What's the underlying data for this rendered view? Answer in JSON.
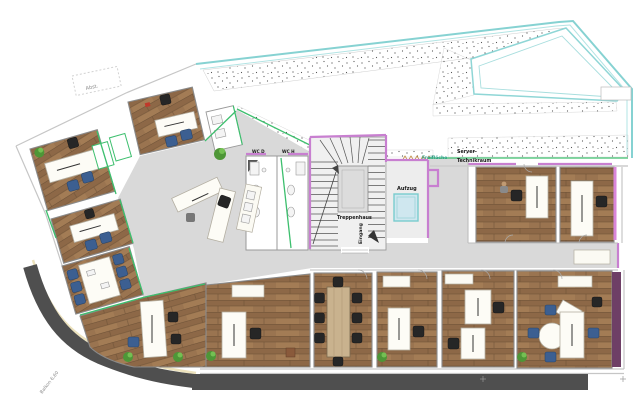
{
  "plan": {
    "type": "floor-plan",
    "labels": {
      "storage": "Abst.",
      "stairwell": "Treppenhaus",
      "entrance": "Eingang",
      "elevator": "Aufzug",
      "open_area": "Freifläche",
      "server_room_line1": "Server-",
      "server_room_line2": "Technikraum",
      "wc_women": "WC D",
      "wc_men": "WC H",
      "balcony": "Balkon 6,60"
    },
    "colors": {
      "wood_floor": "#9a7450",
      "corridor_floor": "#d9d9d9",
      "terrace_outline": "#86d2d2",
      "wall_magenta": "#c87fd0",
      "wall_green": "#3dbf6e",
      "chair_blue": "#3c5f91",
      "balcony_band": "#4f4f4f",
      "elevator_cabin": "#cfe7ef",
      "conference_table": "#c9b28e",
      "wall_dark_purple": "#6e3f66"
    }
  }
}
